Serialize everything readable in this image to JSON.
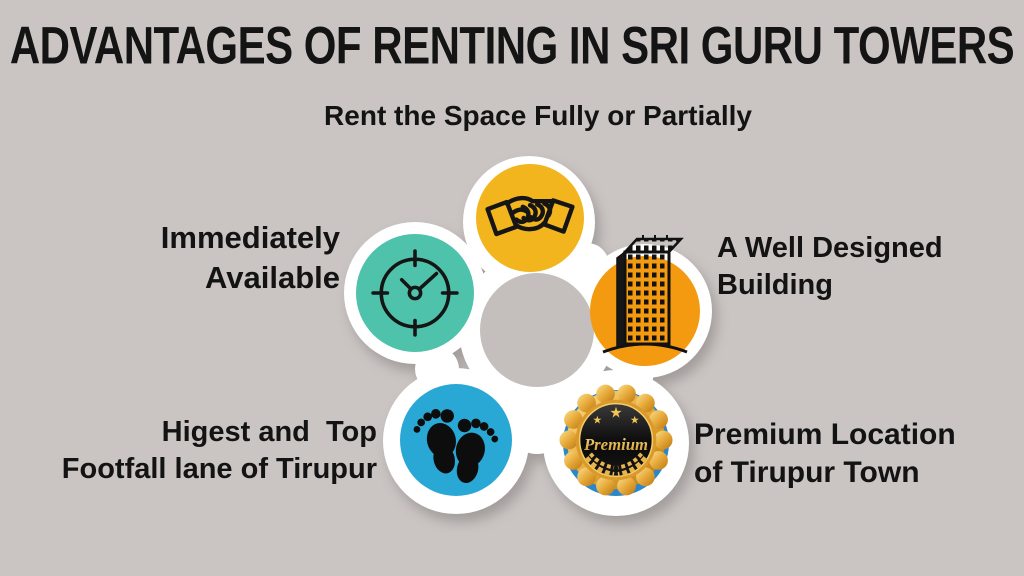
{
  "title": "ADVANTAGES OF RENTING IN SRI GURU TOWERS",
  "items": [
    {
      "id": "rent",
      "label": "Rent the Space Fully or Partially",
      "lines": [
        "Rent the Space Fully or Partially"
      ],
      "icon": "handshake-icon",
      "circle_color": "#F2B51E"
    },
    {
      "id": "available",
      "label": "Immediately Available",
      "lines": [
        "Immediately",
        "Available"
      ],
      "icon": "clock-icon",
      "circle_color": "#4EC2AA"
    },
    {
      "id": "building",
      "label": "A Well Designed Building",
      "lines": [
        "A Well Designed",
        "Building"
      ],
      "icon": "building-icon",
      "circle_color": "#F49A10"
    },
    {
      "id": "footfall",
      "label": "Higest and  Top Footfall lane of Tirupur",
      "lines": [
        "Higest and  Top",
        "Footfall lane of Tirupur"
      ],
      "icon": "footprints-icon",
      "circle_color": "#29A8D5"
    },
    {
      "id": "premium",
      "label": "Premium Location of Tirupur Town",
      "lines": [
        "Premium Location",
        "of Tirupur Town"
      ],
      "icon": "premium-badge-icon",
      "circle_color": "#2B87C8"
    }
  ],
  "badge": {
    "text": "Premium"
  },
  "colors": {
    "background": "#CAC5C3",
    "center_disc": "#C4BFBD",
    "ring_white": "#FFFFFF",
    "text": "#131313",
    "icon_stroke": "#151515",
    "badge_gold_light": "#F9E08E",
    "badge_gold_dark": "#BA7811",
    "badge_face_dark": "#0A0A0A",
    "badge_text_gold": "#EFC253"
  }
}
